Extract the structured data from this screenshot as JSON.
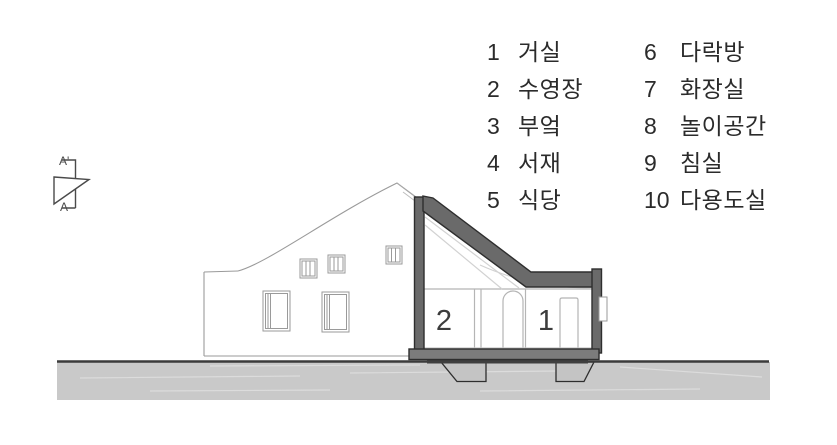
{
  "legend": {
    "items": [
      {
        "num": "1",
        "label": "거실"
      },
      {
        "num": "2",
        "label": "수영장"
      },
      {
        "num": "3",
        "label": "부엌"
      },
      {
        "num": "4",
        "label": "서재"
      },
      {
        "num": "5",
        "label": "식당"
      },
      {
        "num": "6",
        "label": "다락방"
      },
      {
        "num": "7",
        "label": "화장실"
      },
      {
        "num": "8",
        "label": "놀이공간"
      },
      {
        "num": "9",
        "label": "침실"
      },
      {
        "num": "10",
        "label": "다용도실"
      }
    ]
  },
  "drawing": {
    "room_labels": {
      "pool": "2",
      "living": "1"
    },
    "section_marker": {
      "top": "A'",
      "bottom": "A"
    },
    "colors": {
      "cut_wall": "#6a6a6a",
      "cut_outline": "#2e2e2e",
      "slab": "#7c7c7c",
      "under_slab": "#3f3f3f",
      "ground": "#c9c9c9",
      "ground_line": "#3b3b3b",
      "elevation_line": "#9a9a9a",
      "interior_line": "#b5b5b5"
    }
  }
}
